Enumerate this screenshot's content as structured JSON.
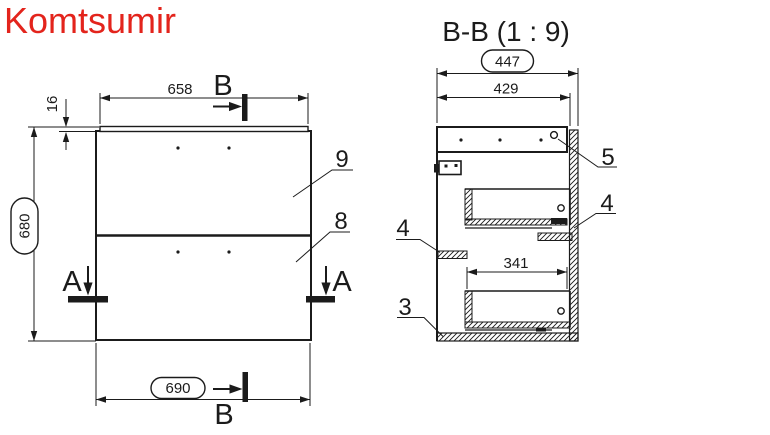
{
  "title": "Komtsumir",
  "colors": {
    "accent": "#e3241c",
    "line": "#1b1b1b",
    "background": "#ffffff"
  },
  "front_view": {
    "dim_top_width": "658",
    "dim_top_thickness": "16",
    "dim_height": "680",
    "dim_bottom_width": "690",
    "drawer_top_label": "9",
    "drawer_bottom_label": "8",
    "section_a_letter": "A",
    "section_b_letter": "B"
  },
  "section_view": {
    "title": "B-B (1 : 9)",
    "dim_total_depth": "447",
    "dim_side_depth": "429",
    "dim_drawer_depth": "341",
    "top_panel_label": "5",
    "rail_right_label": "4",
    "rail_left_label": "4",
    "bottom_panel_label": "3"
  }
}
